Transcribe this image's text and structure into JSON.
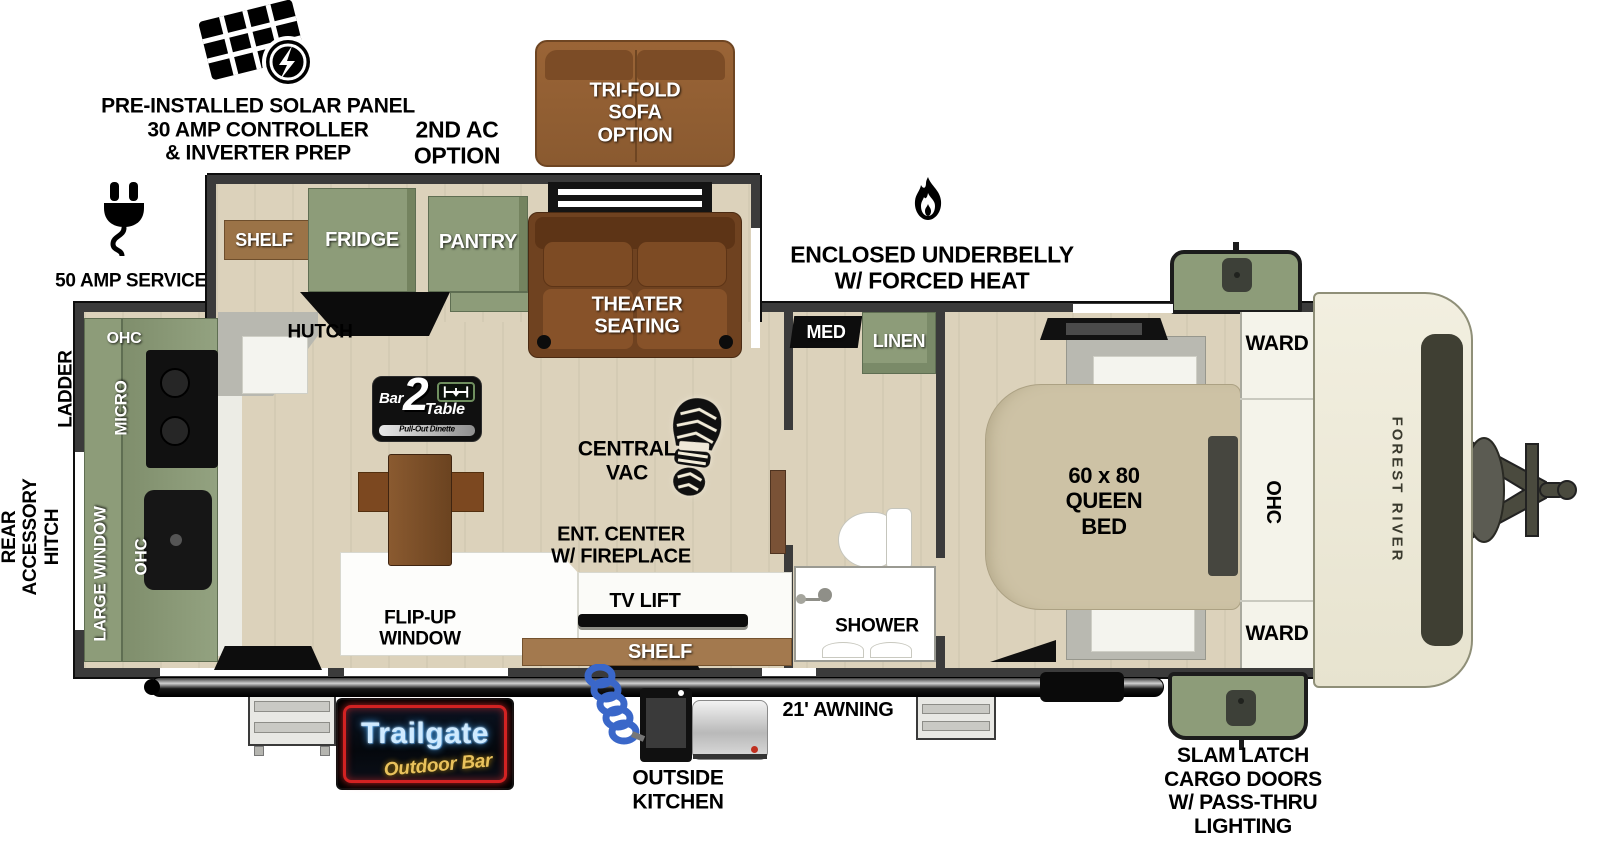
{
  "colors": {
    "cabinet_green": "#8d9c79",
    "sofa_brown": "#6f4220",
    "shelf_brown": "#a3794e",
    "front_cap": "#efecdc",
    "wall": "#3b3b3b",
    "neon_blue": "#cfeaff",
    "neon_yellow": "#e9c25c",
    "neon_red": "#d22222"
  },
  "callouts": {
    "solar": "PRE-INSTALLED SOLAR PANEL\n30 AMP CONTROLLER\n& INVERTER PREP",
    "second_ac": "2ND AC\nOPTION",
    "tri_fold": "TRI-FOLD\nSOFA\nOPTION",
    "amp_service": "50 AMP SERVICE",
    "underbelly": "ENCLOSED UNDERBELLY\nW/ FORCED HEAT",
    "ladder_prep": "LADDER\nPREP",
    "rear_hitch": "REAR\nACCESSORY\nHITCH",
    "awning": "21' AWNING",
    "outside_kitchen": "OUTSIDE\nKITCHEN",
    "slam_latch": "SLAM LATCH\nCARGO DOORS\nW/ PASS-THRU\nLIGHTING",
    "trailgate_title": "Trailgate",
    "trailgate_sub": "Outdoor Bar"
  },
  "rooms": {
    "kitchen": {
      "ohc_top": "OHC",
      "micro": "MICRO",
      "large_window": "LARGE WINDOW",
      "ohc_bottom": "OHC",
      "hutch": "HUTCH",
      "shelf": "SHELF",
      "fridge": "FRIDGE",
      "pantry": "PANTRY"
    },
    "living": {
      "theater": "THEATER\nSEATING",
      "central_vac": "CENTRAL\nVAC",
      "ent_center": "ENT. CENTER\nW/ FIREPLACE",
      "tv_lift": "TV LIFT",
      "shelf": "SHELF",
      "flip_up": "FLIP-UP\nWINDOW"
    },
    "dinette": {
      "bar": "Bar",
      "two": "2",
      "table": "Table",
      "sub": "Pull-Out Dinette"
    },
    "bath": {
      "med": "MED",
      "linen": "LINEN",
      "shower": "SHOWER"
    },
    "bedroom": {
      "bed": "60 x 80\nQUEEN\nBED",
      "ward_top": "WARD",
      "ohc": "OHC",
      "ward_bottom": "WARD"
    },
    "brand": "FOREST RIVER"
  }
}
